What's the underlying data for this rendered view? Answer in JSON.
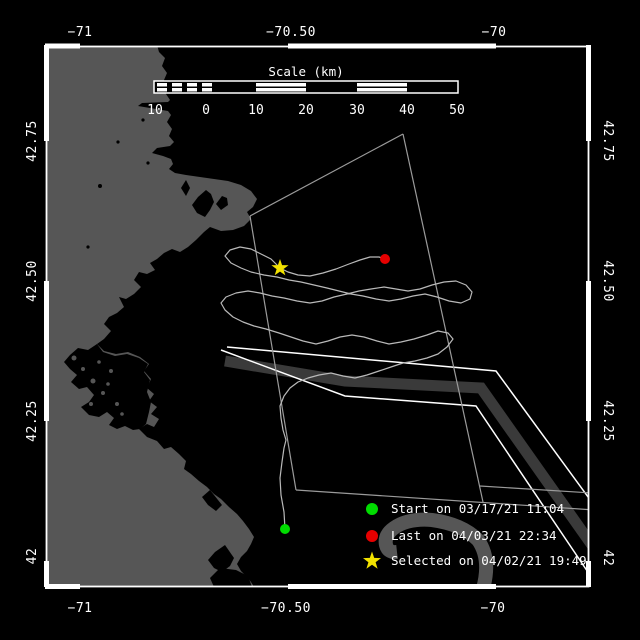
{
  "figure": {
    "title": "Drifter track map",
    "colors": {
      "background": "#000000",
      "land": "#565656",
      "shipping_lane": "#3a3a3a",
      "frame": "#ffffff",
      "track": "#b9b9b9",
      "boundary_line": "#9b9b9b",
      "start_marker": "#00dc00",
      "last_marker": "#e60000",
      "selected_marker": "#f2e200"
    }
  },
  "axes": {
    "lon_top": [
      "−71",
      "−70.50",
      "−70"
    ],
    "lon_bottom": [
      "−71",
      "−70.50",
      "−70"
    ],
    "lat_left": [
      "42.75",
      "42.50",
      "42.25",
      "42"
    ],
    "lat_right": [
      "42.75",
      "42.50",
      "42.25",
      "42"
    ]
  },
  "scale_bar": {
    "title": "Scale (km)",
    "labels": [
      "10",
      "0",
      "10",
      "20",
      "30",
      "40",
      "50"
    ]
  },
  "legend": [
    {
      "icon": "green-dot",
      "color": "#00dc00",
      "label": "Start on 03/17/21 11:04"
    },
    {
      "icon": "red-dot",
      "color": "#e60000",
      "label": "Last on 04/03/21 22:34"
    },
    {
      "icon": "yellow-star",
      "color": "#f2e200",
      "label": "Selected on 04/02/21 19:49"
    }
  ]
}
